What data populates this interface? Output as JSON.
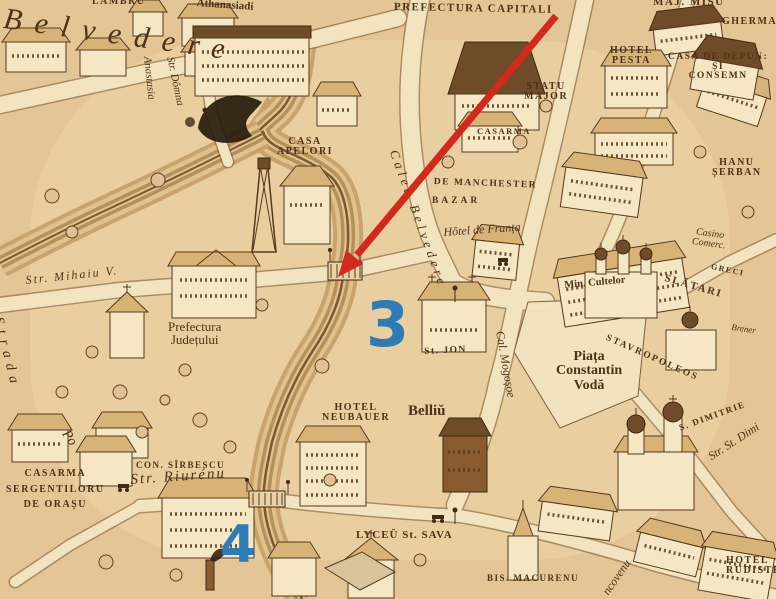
{
  "map": {
    "description": "Engraved bird's-eye map detail (Bucharest, Dambovita river area) with red arrow and blue numeral annotations",
    "paper_color": "#e8cb9c",
    "ink_color": "#4c3318"
  },
  "labels": {
    "belvedere": "Belvedere",
    "lambru": "LAMBRU",
    "athanasiadi": "Athanasiadi",
    "prefectura_capitali": "PREFECTURA CAPITALI",
    "maj_misu": "MAJ. MIȘU",
    "gherman": "GHERMAN",
    "hotel_pesta": "HOTEL\nPESTA",
    "casa_de_depuneri": "CASA DE DEPUN:\nȘI\nCONSEMN",
    "statu_major": "STATU\nMAJOR",
    "casarma": "CASARMA",
    "hanu_serban": "HANU\nȘERBAN",
    "casa_apelor": "CASA\nAPELORI",
    "calea_belvedere": "Calea Belvedere",
    "de_manchester": "DE MANCHESTER",
    "bazar": "BAZAR",
    "hotel_de_franta": "Hôtel de Franța",
    "anastasia": "Anastasia",
    "str_domna": "Str. Dômna",
    "str_mihai_v": "Str. Mihaiu V.",
    "strada": "Strada",
    "po": "Po",
    "prefectura_judetului": "Prefectura\nJudețului",
    "casino_comerc": "Casino\nComerc.",
    "greci": "GRECI",
    "slatari": "SLĂTARI",
    "min_cultelor": "Min. Cultelor",
    "stavropoleos": "STAVROPOLEOS",
    "piata_constantin_voda": "Piața\nConstantin\nVodă",
    "st_jon": "St. JON",
    "belliu": "Belliŭ",
    "hotel_neubauer": "HOTEL\nNEUBAUER",
    "cal_mogosoe": "Cal. Mogoșoe",
    "s_dimitrie": "S. DIMITRIE",
    "str_st_dimi": "Str. St. Dimi",
    "brener": "Brener",
    "casarma_sergentiloru": "CASARMA\nSERGENTILORU\nDE ORAȘU",
    "con_sirbescu": "CON. SÎRBESCU",
    "str_riurenu": "Str. Riurénu",
    "lyceu_st_sava": "LYCEŬ St. SAVA",
    "bis_macurenu": "BIS. MACURENU",
    "brancovenu": "ncovenu",
    "hotel_rudiste": "HOTEL\nRUDISTE"
  },
  "annotations": {
    "marker_3": "3",
    "marker_4": "4",
    "marker_color": "#2e7cb5",
    "arrow_color": "#d4281c"
  }
}
